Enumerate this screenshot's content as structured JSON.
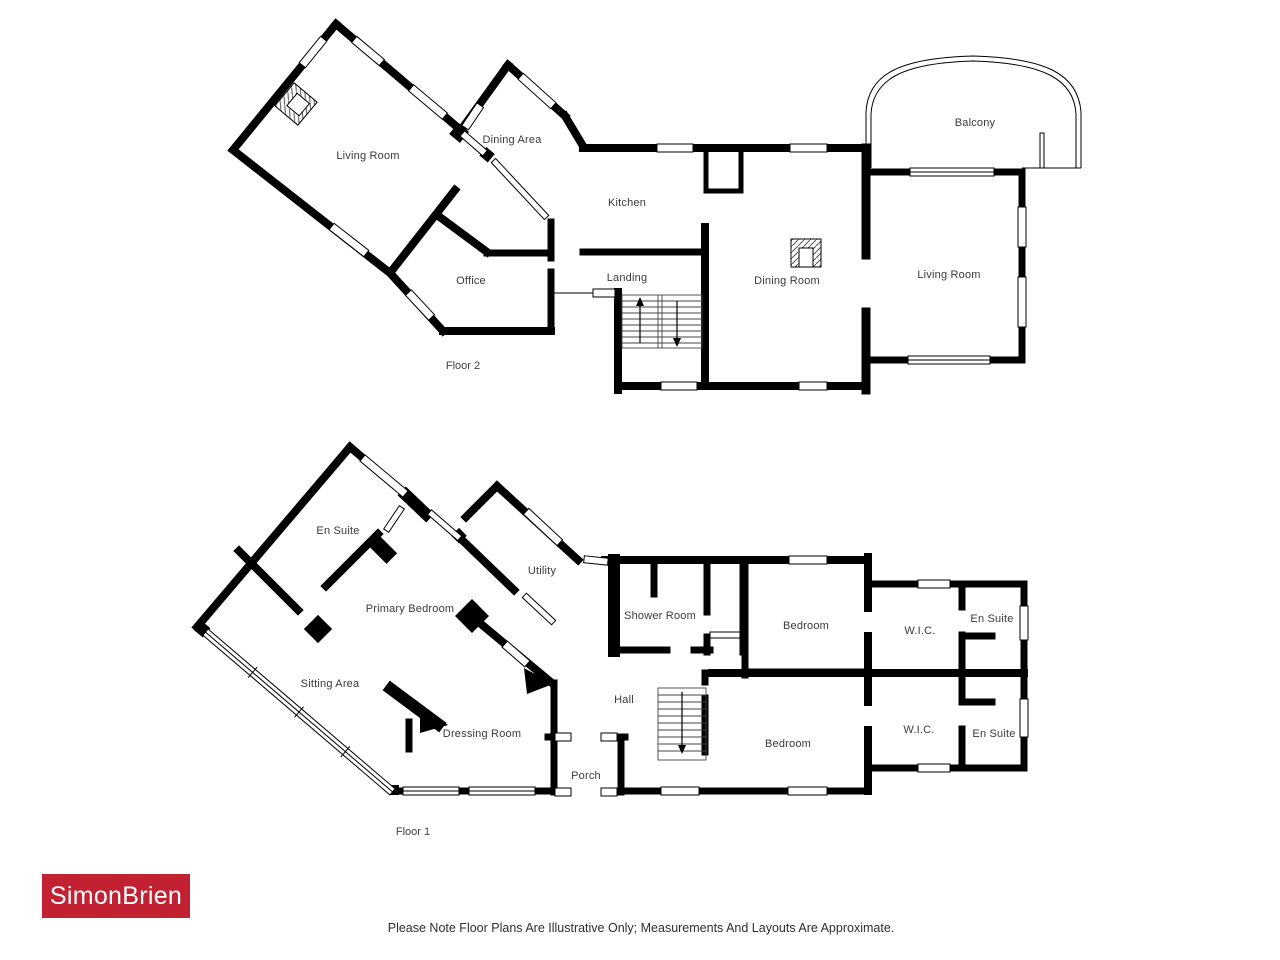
{
  "floor2": {
    "label": "Floor 2",
    "rooms": [
      {
        "name": "Living Room"
      },
      {
        "name": "Dining Area"
      },
      {
        "name": "Kitchen"
      },
      {
        "name": "Office"
      },
      {
        "name": "Landing"
      },
      {
        "name": "Dining Room"
      },
      {
        "name": "Living Room"
      },
      {
        "name": "Balcony"
      }
    ],
    "features": [
      "fireplace-living-room",
      "fireplace-dining-room",
      "staircase",
      "balcony-arch"
    ]
  },
  "floor1": {
    "label": "Floor 1",
    "rooms": [
      {
        "name": "En Suite"
      },
      {
        "name": "Utility"
      },
      {
        "name": "Primary Bedroom"
      },
      {
        "name": "Shower Room"
      },
      {
        "name": "Bedroom"
      },
      {
        "name": "W.I.C."
      },
      {
        "name": "En Suite"
      },
      {
        "name": "Sitting Area"
      },
      {
        "name": "Dressing Room"
      },
      {
        "name": "Hall"
      },
      {
        "name": "Bedroom"
      },
      {
        "name": "W.I.C."
      },
      {
        "name": "En Suite"
      },
      {
        "name": "Porch"
      }
    ],
    "features": [
      "staircase",
      "glazed-window-wall",
      "porch-entrance"
    ]
  },
  "branding": {
    "logo_text": "SimonBrien",
    "logo_bg": "#C22132",
    "logo_color": "#FFFFFF"
  },
  "disclaimer": "Please Note Floor Plans Are Illustrative Only; Measurements And Layouts Are Approximate.",
  "colors": {
    "background": "#FFFFFF",
    "wall": "#000000",
    "label_text": "#3A3A3A"
  }
}
